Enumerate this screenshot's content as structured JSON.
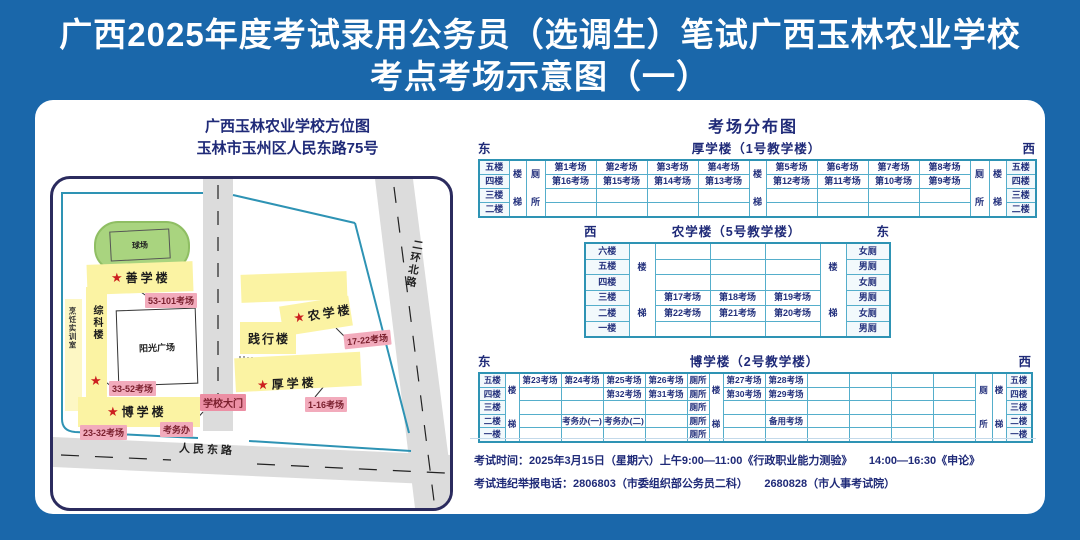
{
  "page_title": {
    "line1": "广西2025年度考试录用公务员（选调生）笔试广西玉林农业学校",
    "line2": "考点考场示意图（一）"
  },
  "map": {
    "title_line1": "广西玉林农业学校方位图",
    "title_line2": "玉林市玉州区人民东路75号",
    "stadium_label": "球场",
    "plaza_label": "阳光广场",
    "gate_label": "学校大门",
    "exam_office_label": "考务办",
    "star_glyph": "★",
    "buildings": {
      "shanxue": "善学楼",
      "zongke": "综科楼",
      "pengren": "烹饪实训室",
      "boxue": "博学楼",
      "jianxing": "践行楼",
      "nongxue": "农学楼",
      "houxue": "厚学楼"
    },
    "room_labels": {
      "shanxue": "53-101考场",
      "zongke": "33-52考场",
      "boxue": "23-32考场",
      "nongxue": "17-22考场",
      "houxue": "1-16考场"
    },
    "roads": {
      "east_road": "人民东路",
      "north_road": "二环北路"
    }
  },
  "distribution": {
    "heading": "考场分布图",
    "tables": [
      {
        "id": "houxue",
        "corner_left": "东",
        "corner_right": "西",
        "title": "厚学楼（1号教学楼）",
        "cols": [
          {
            "w": 30,
            "kind": "floor",
            "cells": [
              "五楼",
              "四楼",
              "三楼",
              "二楼"
            ]
          },
          {
            "w": 17,
            "span": "楼梯"
          },
          {
            "w": 19,
            "span": "厕所"
          },
          {
            "w": 51,
            "cells": [
              "第1考场",
              "第16考场",
              "",
              ""
            ]
          },
          {
            "w": 51,
            "cells": [
              "第2考场",
              "第15考场",
              "",
              ""
            ]
          },
          {
            "w": 51,
            "cells": [
              "第3考场",
              "第14考场",
              "",
              ""
            ]
          },
          {
            "w": 51,
            "cells": [
              "第4考场",
              "第13考场",
              "",
              ""
            ]
          },
          {
            "w": 17,
            "span": "楼梯"
          },
          {
            "w": 51,
            "cells": [
              "第5考场",
              "第12考场",
              "",
              ""
            ]
          },
          {
            "w": 51,
            "cells": [
              "第6考场",
              "第11考场",
              "",
              ""
            ]
          },
          {
            "w": 51,
            "cells": [
              "第7考场",
              "第10考场",
              "",
              ""
            ]
          },
          {
            "w": 51,
            "cells": [
              "第8考场",
              "第9考场",
              "",
              ""
            ]
          },
          {
            "w": 19,
            "span": "厕所"
          },
          {
            "w": 17,
            "span": "楼梯"
          },
          {
            "w": 30,
            "kind": "floor",
            "cells": [
              "五楼",
              "四楼",
              "三楼",
              "二楼"
            ]
          }
        ]
      },
      {
        "id": "nongxue",
        "corner_left": "西",
        "corner_right": "东",
        "title": "农学楼（5号教学楼）",
        "cols": [
          {
            "w": 44,
            "kind": "floor",
            "cells": [
              "六楼",
              "五楼",
              "四楼",
              "三楼",
              "二楼",
              "一楼"
            ]
          },
          {
            "w": 26,
            "span": "楼梯"
          },
          {
            "w": 55,
            "cells": [
              "",
              "",
              "",
              "第17考场",
              "第22考场",
              ""
            ]
          },
          {
            "w": 55,
            "cells": [
              "",
              "",
              "",
              "第18考场",
              "第21考场",
              ""
            ]
          },
          {
            "w": 55,
            "cells": [
              "",
              "",
              "",
              "第19考场",
              "第20考场",
              ""
            ]
          },
          {
            "w": 26,
            "span": "楼梯"
          },
          {
            "w": 44,
            "kind": "floor",
            "cells": [
              "女厕",
              "男厕",
              "女厕",
              "男厕",
              "女厕",
              "男厕"
            ]
          }
        ]
      },
      {
        "id": "boxue",
        "corner_left": "东",
        "corner_right": "西",
        "title": "博学楼（2号教学楼）",
        "cols": [
          {
            "w": 26,
            "kind": "floor",
            "cells": [
              "五楼",
              "四楼",
              "三楼",
              "二楼",
              "一楼"
            ]
          },
          {
            "w": 14,
            "span": "楼梯"
          },
          {
            "w": 42,
            "cells": [
              "第23考场",
              "",
              "",
              "",
              ""
            ]
          },
          {
            "w": 42,
            "cells": [
              "第24考场",
              "",
              "",
              "考务办(一)",
              ""
            ]
          },
          {
            "w": 42,
            "cells": [
              "第25考场",
              "第32考场",
              "",
              "考务办(二)",
              ""
            ]
          },
          {
            "w": 42,
            "cells": [
              "第26考场",
              "第31考场",
              "",
              "",
              ""
            ]
          },
          {
            "w": 22,
            "cells": [
              "厕所",
              "厕所",
              "厕所",
              "厕所",
              "厕所"
            ]
          },
          {
            "w": 14,
            "span": "楼梯"
          },
          {
            "w": 42,
            "cells": [
              "第27考场",
              "第30考场",
              "",
              "",
              ""
            ]
          },
          {
            "w": 42,
            "cells": [
              "第28考场",
              "第29考场",
              "",
              "备用考场",
              ""
            ]
          },
          {
            "w": 42,
            "cells": [
              "",
              "",
              "",
              "",
              ""
            ]
          },
          {
            "w": 42,
            "cells": [
              "",
              "",
              "",
              "",
              ""
            ]
          },
          {
            "w": 42,
            "cells": [
              "",
              "",
              "",
              "",
              ""
            ]
          },
          {
            "w": 42,
            "cells": [
              "",
              "",
              "",
              "",
              ""
            ]
          },
          {
            "w": 17,
            "span": "厕所"
          },
          {
            "w": 14,
            "span": "楼梯"
          },
          {
            "w": 26,
            "kind": "floor",
            "cells": [
              "五楼",
              "四楼",
              "三楼",
              "二楼",
              "一楼"
            ]
          }
        ]
      }
    ]
  },
  "notes": {
    "line1": "考试时间：2025年3月15日（星期六）上午9:00—11:00《行政职业能力测验》　　14:00—16:30《申论》",
    "line2": "考试违纪举报电话：2806803（市委组织部公务员二科）　　2680828（市人事考试院）"
  },
  "colors": {
    "background_blue": "#1a67aa",
    "navy_text": "#1f2a78",
    "table_border": "#55aecb",
    "building_yellow": "#fbf3a3",
    "label_pink": "#f2abbc",
    "label_text_red": "#7a1f2d",
    "star_red": "#cc1f1f",
    "stadium_green": "#a9d47f",
    "road_gray": "#dcdcdc",
    "boundary_teal": "#2e93b4"
  }
}
